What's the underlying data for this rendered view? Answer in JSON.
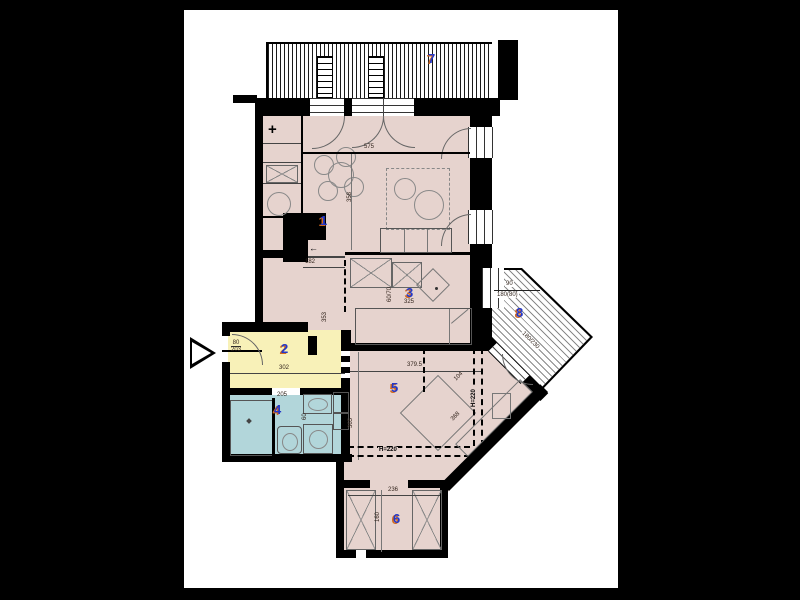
{
  "colors": {
    "background": "#000000",
    "page": "#ffffff",
    "room_fill": "#e6d3ce",
    "hall_fill": "#f8f1b8",
    "bath_fill": "#b2d6da",
    "label_blue": "#2438c8",
    "label_shadow_orange": "#d2691e",
    "wall": "#000000"
  },
  "rooms": [
    {
      "number": "1",
      "name": "living-room-kitchen"
    },
    {
      "number": "2",
      "name": "entrance-hall"
    },
    {
      "number": "3",
      "name": "study"
    },
    {
      "number": "4",
      "name": "bathroom"
    },
    {
      "number": "5",
      "name": "bedroom"
    },
    {
      "number": "6",
      "name": "dressing-room"
    },
    {
      "number": "7",
      "name": "balcony"
    },
    {
      "number": "8",
      "name": "terrace"
    }
  ],
  "dims": {
    "room1_width": "575",
    "room1_depth": "358",
    "corridor_width": "182",
    "corridor_depth": "353",
    "study_width": "325",
    "study_door": "60/70",
    "entry_door_width": "80",
    "entry_door_height": "203",
    "hall_width": "302",
    "bath_width": "205",
    "bath_fixture": "60",
    "bedroom_width": "379.5",
    "bedroom_depth": "365",
    "height_note": "H=220",
    "nook_a": "104",
    "nook_b": "368",
    "dressing_width": "236",
    "dressing_depth": "160",
    "terrace_window_top": "90",
    "terrace_window_bottom": "180(80)",
    "terrace_door": "180/230"
  },
  "symbols": {
    "plus": "+",
    "arrow_left": "←"
  }
}
